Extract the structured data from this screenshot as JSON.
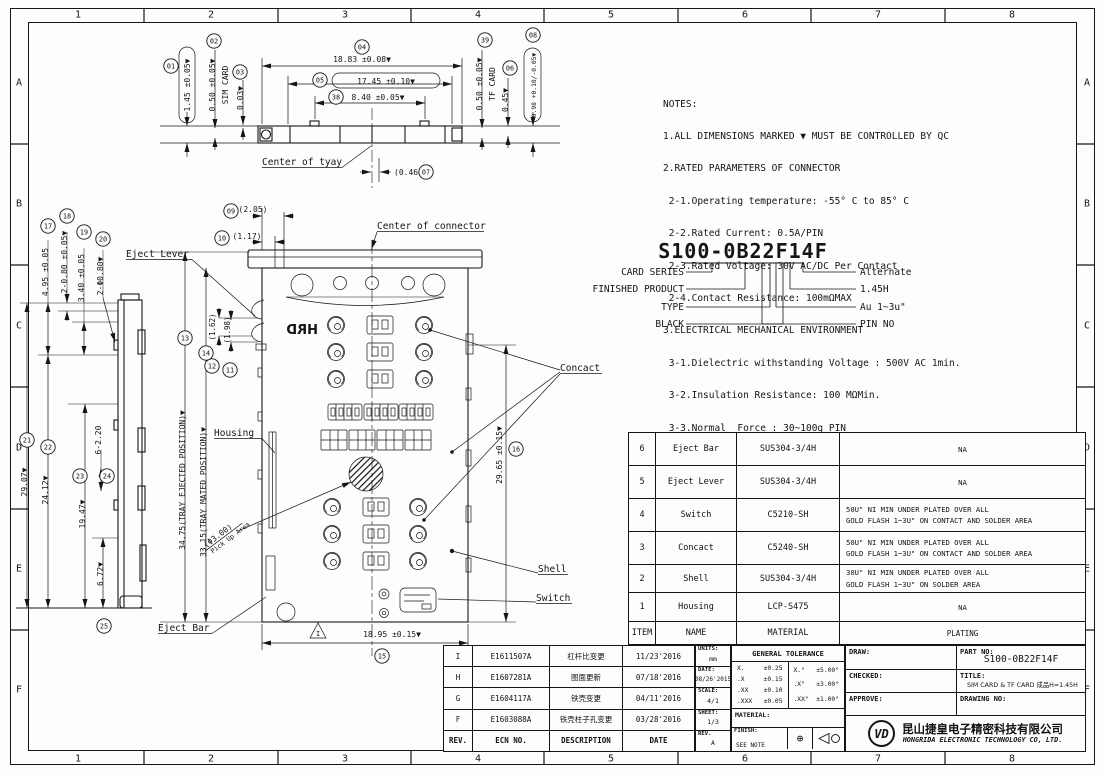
{
  "frame": {
    "columns": [
      "1",
      "2",
      "3",
      "4",
      "5",
      "6",
      "7",
      "8"
    ],
    "rows": [
      "A",
      "B",
      "C",
      "D",
      "E",
      "F"
    ]
  },
  "balloons": {
    "b01": "01",
    "b02": "02",
    "b03": "03",
    "b04": "04",
    "b05": "05",
    "b06": "06",
    "b07": "07",
    "b08": "08",
    "b09": "09",
    "b10": "10",
    "b11": "11",
    "b12": "12",
    "b13": "13",
    "b14": "14",
    "b15": "15",
    "b16": "16",
    "b17": "17",
    "b18": "18",
    "b19": "19",
    "b20": "20",
    "b21": "21",
    "b22": "22",
    "b23": "23",
    "b24": "24",
    "b25": "25",
    "b38": "38",
    "b39": "39"
  },
  "top_view": {
    "dims": {
      "d01": "1.45 ±0.05▼",
      "d02": "0.50 ±0.05▼",
      "d02_note": "SIM CARD",
      "d03": "0.03▼",
      "d04": "18.83 ±0.08▼",
      "d05": "17.45 ±0.10▼",
      "d38": "8.40 ±0.05▼",
      "d39": "0.50 ±0.05▼",
      "d39_note": "TF CARD",
      "d06": "0.45▼",
      "d08": "0.98 +0.10/-0.05▼",
      "d07": "(0.46)"
    },
    "labels": {
      "center_of_tray": "Center of tyay"
    }
  },
  "main_view": {
    "dims": {
      "d09": "(2.05)",
      "d10": "(1.17)",
      "d11": "(1.98)",
      "d12": "(1.62)",
      "d13": "34.75(TRAY EJECTED POSITION)▼",
      "d14": "33.15(TRAY MATED POSITION)▼",
      "d15": "18.95 ±0.15▼",
      "d16": "29.65 ±0.15▼",
      "pickup_dia": "(Φ3.00)",
      "pickup_label": "Pick Up Area"
    },
    "labels": {
      "center_of_connector": "Center of connector",
      "eject_lever": "Eject Lever",
      "housing": "Housing",
      "concact": "Concact",
      "shell": "Shell",
      "switch": "Switch",
      "eject_bar": "Eject Bar",
      "housing_logo": "HRD",
      "rev_triangle": "I"
    }
  },
  "side_view": {
    "dims": {
      "d17": "4.95 ±0.05",
      "d18": "2-0.80 ±0.05▼",
      "d19": "3.40 ±0.05",
      "d20": "2-Φ0.80▼",
      "d21": "29.07▼",
      "d22": "24.12▼",
      "d23": "19.47▼",
      "d24": "6-2.20",
      "d25": "6.72▼"
    }
  },
  "notes": {
    "lines": [
      "NOTES:",
      "1.ALL DIMENSIONS MARKED ▼ MUST BE CONTROLLED BY QC",
      "2.RATED PARAMETERS OF CONNECTOR",
      " 2-1.Operating temperature: -55° C to 85° C",
      " 2-2.Rated Current: 0.5A/PIN",
      " 2-3.Rated Voltage: 30V AC/DC Per Contact",
      " 2-4.Contact Resistance: 100mΩMAX",
      "3.ELECTRICAL MECHANICAL ENVIRONMENT",
      " 3-1.Dielectric withstanding Voltage : 500V AC 1min.",
      " 3-2.Insulation Resistance: 100 MΩMin.",
      " 3-3.Normal  Force : 30~100g PIN",
      " 3-4.Insertion  Force: 1.0Kg Max",
      " 3-5.Extraction  Force: 0.2Kg Min",
      " 3-6.Durability: 3000 cycles",
      "4.PART NO"
    ]
  },
  "part_no_section": {
    "part_number": "S100-0B22F14F",
    "left_labels": [
      "CARD SERIES",
      "FINISHED PRODUCT",
      "TYPE",
      "BLACK"
    ],
    "right_labels": [
      "Alternate",
      "1.45H",
      "Au 1~3u\"",
      "PIN NO"
    ]
  },
  "parts_table": {
    "headers": {
      "item": "ITEM",
      "name": "NAME",
      "material": "MATERIAL",
      "plating": "PLATING"
    },
    "rows": [
      {
        "item": "6",
        "name": "Eject Bar",
        "material": "SUS304-3/4H",
        "plating1": "NA",
        "plating2": ""
      },
      {
        "item": "5",
        "name": "Eject Lever",
        "material": "SUS304-3/4H",
        "plating1": "NA",
        "plating2": ""
      },
      {
        "item": "4",
        "name": "Switch",
        "material": "C5210-SH",
        "plating1": "50U\" NI MIN UNDER PLATED OVER ALL",
        "plating2": "GOLD FLASH 1~3U\" ON CONTACT AND SOLDER AREA"
      },
      {
        "item": "3",
        "name": "Concact",
        "material": "C5240-SH",
        "plating1": "50U\" NI MIN UNDER PLATED OVER ALL",
        "plating2": "GOLD FLASH 1~3U\" ON CONTACT AND SOLDER AREA"
      },
      {
        "item": "2",
        "name": "Shell",
        "material": "SUS304-3/4H",
        "plating1": "30U\" NI MIN UNDER PLATED OVER ALL",
        "plating2": "GOLD FLASH 1~3U\" ON SOLDER AREA"
      },
      {
        "item": "1",
        "name": "Housing",
        "material": "LCP-S475",
        "plating1": "NA",
        "plating2": ""
      }
    ]
  },
  "revision_table": {
    "headers": {
      "rev": "REV.",
      "ecn": "ECN NO.",
      "description": "DESCRIPTION",
      "date": "DATE"
    },
    "rows": [
      {
        "rev": "I",
        "ecn": "E1611507A",
        "description": "杠杆比变更",
        "date": "11/23'2016"
      },
      {
        "rev": "H",
        "ecn": "E1607281A",
        "description": "图面更新",
        "date": "07/18'2016"
      },
      {
        "rev": "G",
        "ecn": "E1604117A",
        "description": "铁壳变更",
        "date": "04/11'2016"
      },
      {
        "rev": "F",
        "ecn": "E1603088A",
        "description": "铁壳柱子孔变更",
        "date": "03/28'2016"
      }
    ]
  },
  "info_block": {
    "units_label": "UNITS:",
    "units": "mm",
    "date_label": "DATE:",
    "date": "08/26'2015",
    "scale_label": "SCALE:",
    "scale": "4/1",
    "sheet_label": "SHEET:",
    "sheet": "1/3",
    "rev_label": "REV.",
    "rev": "A",
    "tolerance_title": "GENERAL TOLERANCE",
    "tol_rows_left": [
      [
        "X.",
        "±0.25"
      ],
      [
        ".X",
        "±0.15"
      ],
      [
        ".XX",
        "±0.10"
      ],
      [
        ".XXX",
        "±0.05"
      ]
    ],
    "tol_rows_right": [
      [
        "X.°",
        "±5.00°"
      ],
      [
        ".X°",
        "±3.00°"
      ],
      [
        ".XX°",
        "±1.00°"
      ]
    ],
    "material_label": "MATERIAL:",
    "finish_label": "FINISH:",
    "finish_value": "SEE NOTE"
  },
  "title_block": {
    "draw_label": "DRAW:",
    "checked_label": "CHECKED:",
    "approve_label": "APPROVE:",
    "part_no_label": "PART NO:",
    "part_no": "S100-0B22F14F",
    "title_label": "TITLE:",
    "title_value": "SIM CARD & TF CARD 成品H=1.45H",
    "drawing_no_label": "DRAWING NO:",
    "logo_text": "VD",
    "company_cn": "昆山捷皇电子精密科技有限公司",
    "company_en": "HONGRIDA ELECTRONIC TECHNOLOGY CO, LTD."
  }
}
